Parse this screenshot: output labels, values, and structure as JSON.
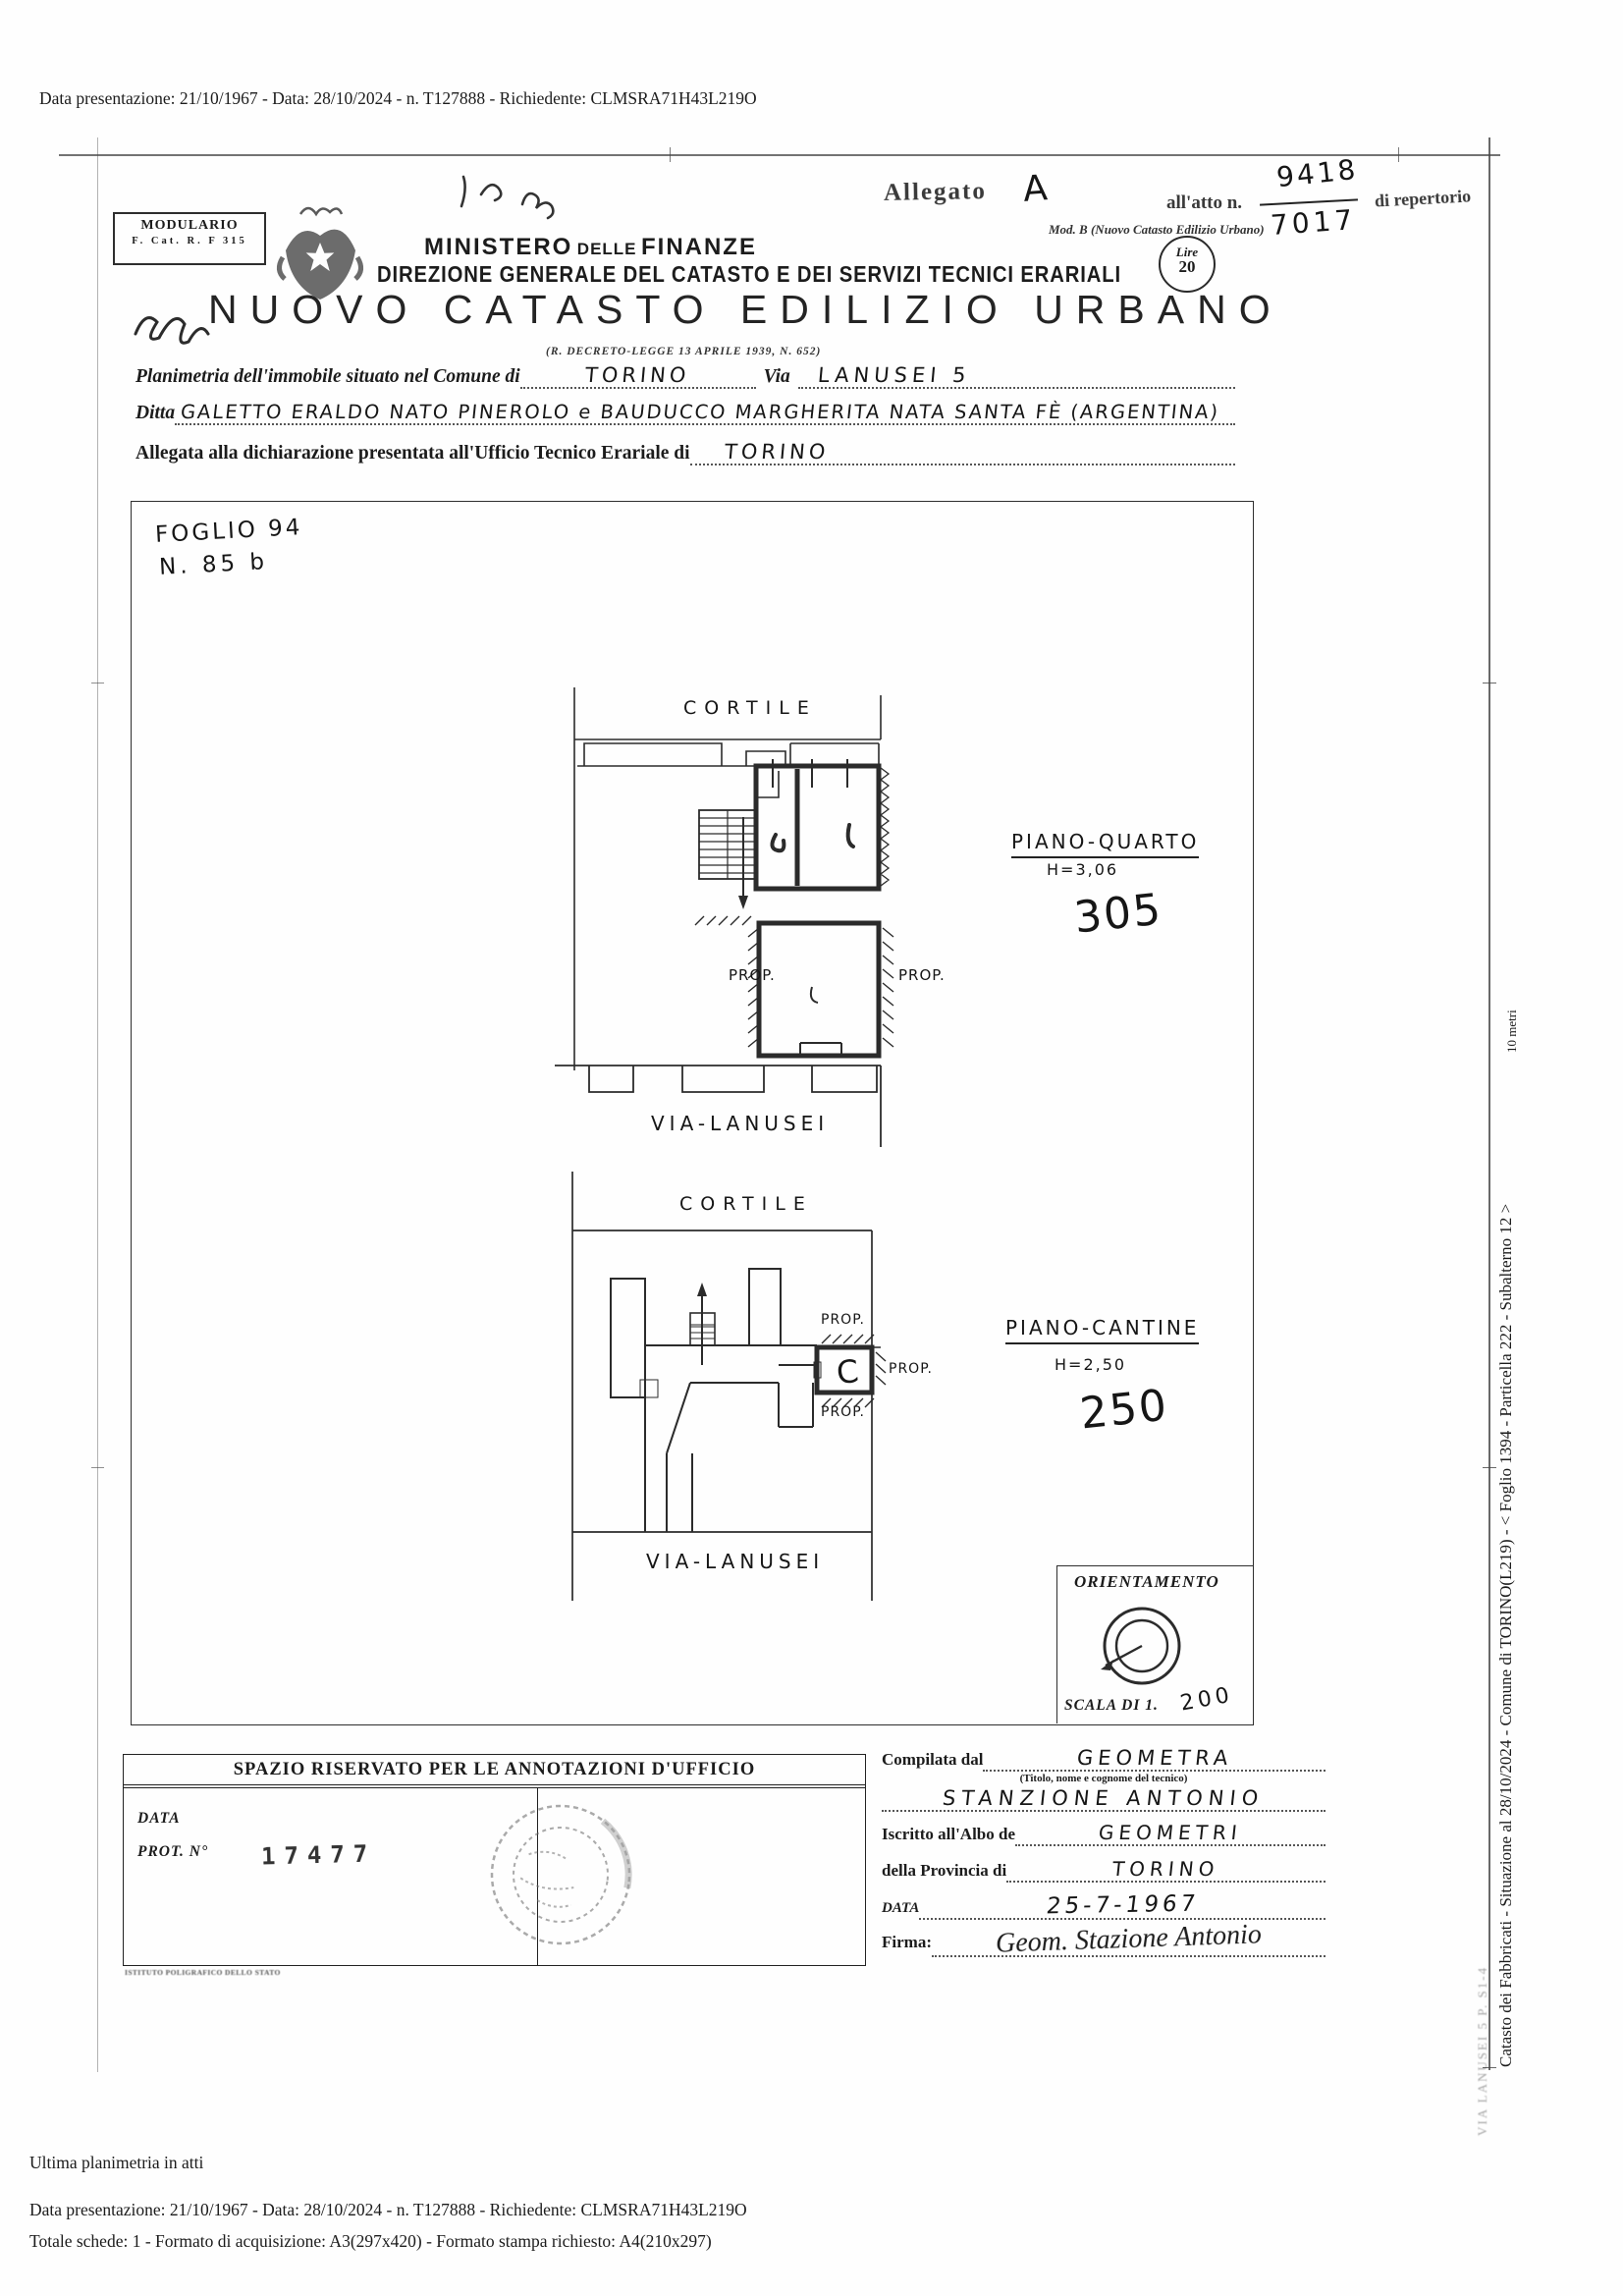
{
  "doc": {
    "top_line": "Data presentazione: 21/10/1967 - Data: 28/10/2024 - n. T127888 - Richiedente: CLMSRA71H43L219O",
    "footer": {
      "line1": "Ultima planimetria in atti",
      "line2": "Data presentazione: 21/10/1967 - Data: 28/10/2024 - n. T127888 - Richiedente: CLMSRA71H43L219O",
      "line3": "Totale schede: 1 - Formato di acquisizione: A3(297x420) - Formato stampa richiesto: A4(210x297)"
    },
    "side": {
      "caption": "Catasto dei Fabbricati - Situazione al 28/10/2024 - Comune di TORINO(L219) - < Foglio 1394 - Particella 222 - Subalterno 12 >",
      "caption2": "VIA LANUSEI 5 P. S1-4",
      "meters": "10 metri"
    }
  },
  "header": {
    "allegato_label": "Allegato",
    "allegato_letter": "A",
    "atto_label": "all'atto n.",
    "atto_num": "9418",
    "atto_den": "7017",
    "repertorio_label": "di repertorio",
    "mod_label": "Mod. B (Nuovo Catasto Edilizio Urbano)",
    "modulario_line1": "MODULARIO",
    "modulario_line2": "F. Cat. R. F 315",
    "ministero_1": "MINISTERO",
    "ministero_2": "DELLE",
    "ministero_3": "FINANZE",
    "direzione": "DIREZIONE GENERALE DEL CATASTO E DEI SERVIZI TECNICI ERARIALI",
    "bollo_lire": "Lire",
    "bollo_value": "20",
    "title": "NUOVO CATASTO EDILIZIO URBANO",
    "decreto": "(R. DECRETO-LEGGE 13 APRILE 1939, N. 652)"
  },
  "form": {
    "planimetria_label": "Planimetria dell'immobile situato nel Comune di",
    "comune": "TORINO",
    "via_label": "Via",
    "via_value": "LANUSEI 5",
    "ditta_label": "Ditta",
    "ditta_value": "GALETTO ERALDO NATO PINEROLO e BAUDUCCO MARGHERITA NATA SANTA FÈ (ARGENTINA)",
    "allegata_label": "Allegata alla dichiarazione presentata all'Ufficio Tecnico Erariale di",
    "ufficio": "TORINO"
  },
  "plan": {
    "foglio": "FOGLIO 94",
    "numero": "N. 85 b",
    "piano1": {
      "cortile": "CORTILE",
      "title": "PIANO-QUARTO",
      "altezza": "H=3,06",
      "numero": "305",
      "prop": "PROP.",
      "via": "VIA-LANUSEI"
    },
    "piano2": {
      "cortile": "CORTILE",
      "title": "PIANO-CANTINE",
      "altezza": "H=2,50",
      "numero": "250",
      "lettera": "C",
      "prop": "PROP.",
      "via": "VIA-LANUSEI"
    },
    "orientamento": "ORIENTAMENTO",
    "scala_label": "SCALA DI 1.",
    "scala_value": "200"
  },
  "annotations": {
    "header": "SPAZIO RISERVATO PER LE ANNOTAZIONI D'UFFICIO",
    "data_label": "DATA",
    "prot_label": "PROT. N°",
    "prot_value": "17477",
    "imprint": "ISTITUTO POLIGRAFICO DELLO STATO"
  },
  "compile": {
    "compilata_label": "Compilata dal",
    "qualifica": "GEOMETRA",
    "titolo_note": "(Titolo, nome e cognome del tecnico)",
    "nome": "STANZIONE ANTONIO",
    "albo_label": "Iscritto all'Albo de",
    "albo_value": "GEOMETRI",
    "provincia_label": "della Provincia di",
    "provincia_value": "TORINO",
    "data_label": "DATA",
    "data_value": "25-7-1967",
    "firma_label": "Firma:",
    "firma_value": "Geom. Stazione Antonio"
  }
}
